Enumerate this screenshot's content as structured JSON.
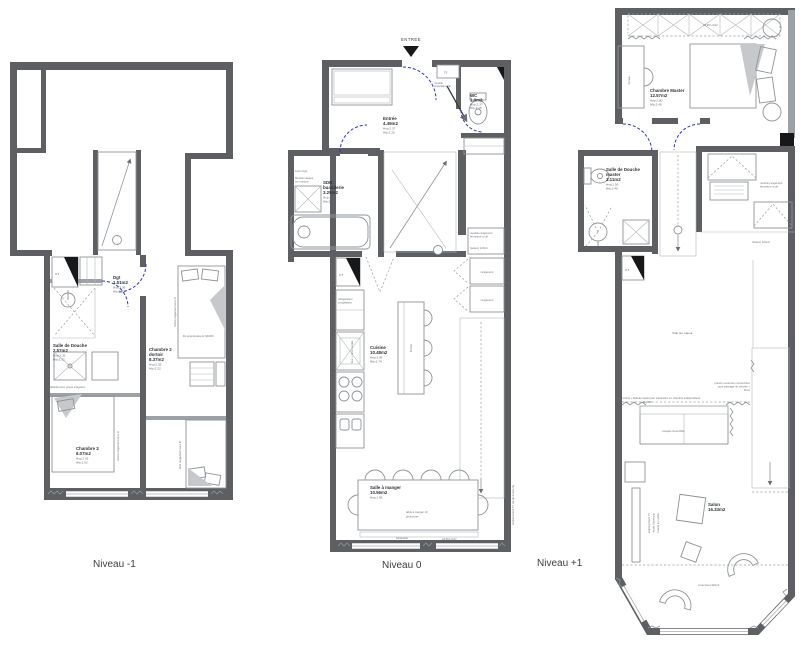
{
  "colors": {
    "wall": "#5d5f63",
    "wall_light": "#9da0a4",
    "door_arc": "#2d31c9",
    "furniture_line": "#8e9498",
    "text": "#4b4e52",
    "background": "#ffffff"
  },
  "plans": [
    {
      "label": "Niveau -1",
      "rooms": [
        {
          "name": "Dgt",
          "area": "1.51m2",
          "hsp": "Hsp:2.36",
          "hfp": "Hfp:2.22"
        },
        {
          "name": "Salle de Douche",
          "area": "2.57m2",
          "hsp": "Hsp:2.35",
          "hfp": "Hfp:2.32"
        },
        {
          "name": "Chambre 2",
          "name2": "dortoir",
          "area": "8.37m2",
          "hsp": "Hsp:2.35",
          "hfp": "Hfp:2.22"
        },
        {
          "name": "Chambre 3",
          "area": "6.07m2",
          "hsp": "Hsp:2.05",
          "hfp": "Hfp:2.02"
        }
      ],
      "annotations": {
        "ct": "CT",
        "shelf": "tablette avec prises intégrées",
        "drawers_right": "tiroirs rangement sous lit",
        "drawers_bottom": "tiroir rangement sous lit",
        "bunk": "lits superposés 2x 90/200"
      }
    },
    {
      "label": "Niveau 0",
      "entry": "ENTREE",
      "rooms": [
        {
          "name": "Entrée",
          "area": "4.49m2",
          "hsp": "Hsp:2.37",
          "hfp": "Hfp:2.25"
        },
        {
          "name": "WC",
          "area": "1.3m2",
          "hsp": "Hsp:2.37",
          "hfp": "Hfp:2.25"
        },
        {
          "name": "SDB",
          "name2": "buanderie",
          "area": "3.29m2",
          "hsp": "Hsp:2.37",
          "hfp": "Hfp:2.27"
        },
        {
          "name": "Cuisine",
          "area": "10.48m2",
          "hsp": "Hsp:3.06",
          "hfp": "Hfp:3.74"
        },
        {
          "name": "Salle à manger",
          "area": "10.56m2",
          "hsp": "Hsp:1.98"
        }
      ],
      "annotations": {
        "te": "TE",
        "ct": "CT",
        "pivot1": "meuble",
        "pivot2": "séparation TE",
        "washer": "Lave linge",
        "vanity1": "Meuble vasque",
        "vanity2": "sur mesure",
        "fridge1": "réfrigérateur",
        "fridge2": "congélateur",
        "oven": "four + micro-ondes",
        "island": "îlot bar",
        "storage1": "rangement",
        "storage2": "rangement",
        "locked1": "meuble rangement",
        "locked2": "fermeture à clé",
        "height": "hauteur 120cm",
        "table1": "table à manger 10",
        "table2": "personnes",
        "bench": "banquette",
        "bench_dim": "All.56 H.127",
        "tv": "emplacement TV étude Samsung"
      }
    },
    {
      "label": "Niveau +1",
      "rooms": [
        {
          "name": "Chambre Master",
          "area": "12.57m2",
          "hsp": "Hsp:2.60",
          "hfp": "Hfp:2.40"
        },
        {
          "name": "Salle de Douche",
          "name2": "master",
          "area": "3.11m2",
          "hsp": "Hsp:2.50",
          "hfp": "Hfp:2.45"
        },
        {
          "name": "Salon",
          "area": "16.33m2"
        }
      ],
      "annotations": {
        "closet_dim": "All.95 H.102",
        "desk": "bureau",
        "ct": "CT",
        "locked1": "meuble rangement",
        "locked2": "fermeture à clé",
        "height": "hauteur 120cm",
        "void": "Vide sur séjour",
        "curtain": "verrière + Rideau épais pour séparation en chambre indépendante",
        "hsp_low": "Hsp:96",
        "pass1": "prévoir ouverture mur/verrière",
        "pass2": "pour passage du meuble +",
        "pass3": "8mm",
        "sofa": "canapé convertible",
        "tv1": "emplacement TV",
        "tv2": "étude Samsung",
        "tv3": "Frame sur socle",
        "ceiling": "zone faux plafond"
      }
    }
  ]
}
